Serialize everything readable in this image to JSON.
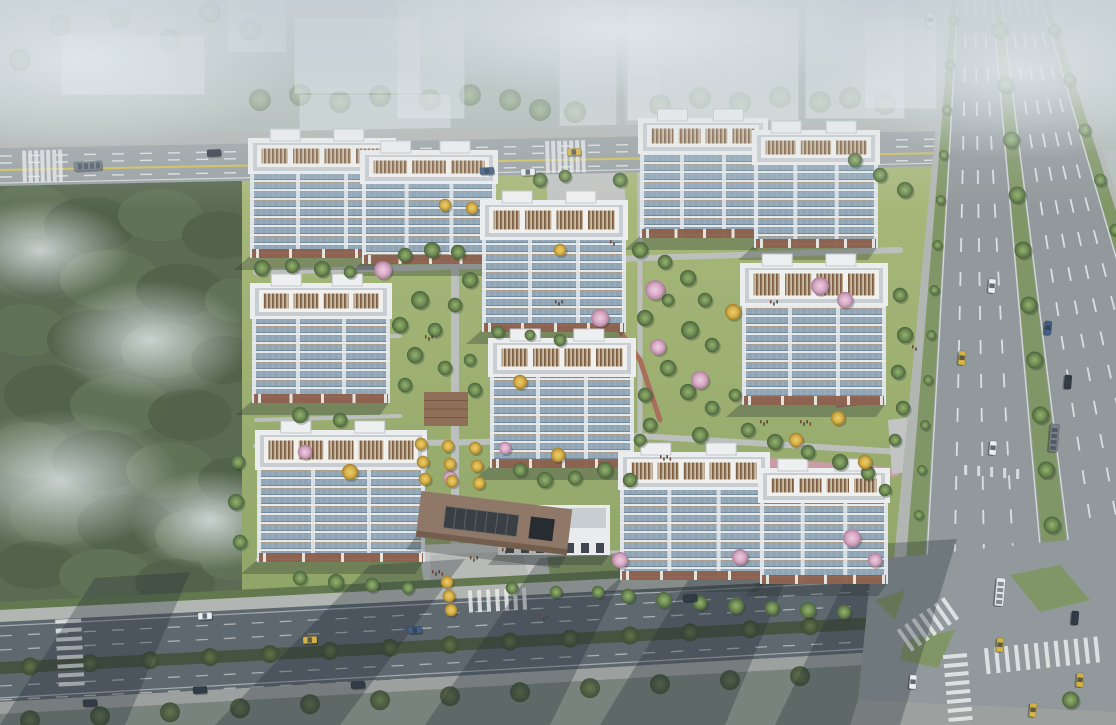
{
  "scene": {
    "type": "aerial-architectural-rendering",
    "description": "Bird's-eye architectural rendering of a residential compound: nine white high-rise apartment slabs with brown roof louvers around landscaped gardens, bordered by a forest on the west, city roads on the north and south, and a wide tree-lined highway on the east, fading into haze at the top.",
    "time_of_day": "daytime-hazy"
  },
  "palette": {
    "haze": "#c7d1d7",
    "context": "#e9eef2",
    "forest0": "#4d5e45",
    "forest1": "#5d7052",
    "fog": "#dfe8ec",
    "lawnA": "#a3b573",
    "lawnB": "#8da464",
    "path": "#bcc0bd",
    "brick": "#a96a58",
    "pinkpath": "#c99ba6",
    "deck": "#8d6b52",
    "road": "#9aa1a3",
    "roadDark": "#59646b",
    "intersection": "#8f979a",
    "sidewalk": "#b2b6b3",
    "sidewalkDark": "#9aa09d",
    "hedge": "#5e7449",
    "hedgeDark": "#3f4e3a",
    "yellow": "#d2c254",
    "white": "#eceeee",
    "highway": "#8f979a",
    "verge": "#7e9462",
    "bldgWhite": "#eef0f1",
    "roofGray": "#c9ced2",
    "louverFrame": "#f3f3f1",
    "baseBrown": "#8a5a45",
    "facadeEdge": "#e8ecef",
    "canopy": "#8d7464",
    "canopyEdge": "#6f5948",
    "skylight": "#33383e",
    "carWhite": "#eef1f2",
    "carDark": "#2b333d",
    "carBlue": "#3c5a82",
    "taxi": "#d6b23e",
    "busDark": "#757e85",
    "busWhite": "#e8eaeb",
    "shadow": "rgba(35,45,45,0.32)",
    "roadShadow": "rgba(26,35,46,0.30)"
  },
  "buildings": [
    [
      638,
      118,
      130,
      120,
      4
    ],
    [
      752,
      130,
      128,
      118,
      3
    ],
    [
      248,
      138,
      148,
      120,
      4
    ],
    [
      360,
      150,
      138,
      114,
      3
    ],
    [
      480,
      200,
      148,
      132,
      4
    ],
    [
      740,
      263,
      148,
      142,
      4
    ],
    [
      250,
      283,
      142,
      120,
      4
    ],
    [
      488,
      338,
      148,
      130,
      4
    ],
    [
      255,
      430,
      172,
      132,
      5
    ],
    [
      618,
      452,
      152,
      128,
      5
    ],
    [
      758,
      468,
      132,
      116,
      4
    ]
  ],
  "clubhouse": [
    498,
    505,
    112,
    50
  ],
  "entrance_canopy": {
    "x": 418,
    "y": 500,
    "w": 152,
    "h": 46,
    "rot": 7
  },
  "top_road": {
    "x0": 0,
    "x1": 945,
    "topY0": 148,
    "topY1": 131,
    "botY0": 186,
    "botY1": 166,
    "dashes": [
      8,
      15,
      29
    ],
    "yellowOffset": 22,
    "crosswalks": [
      22,
      345,
      545
    ]
  },
  "bottom_road": {
    "x0": 0,
    "x1": 872,
    "topY0": 622,
    "topY1": 577,
    "botY0": 702,
    "botY1": 652,
    "dashes": [
      14,
      28,
      64,
      78
    ],
    "median": [
      40,
      52
    ],
    "medianTreeXs": [
      30,
      90,
      150,
      210,
      270,
      330,
      390,
      450,
      510,
      570,
      630,
      690,
      750,
      810
    ]
  },
  "highway": {
    "Ltop": 948,
    "Lbot": 878,
    "Rtop": 1052,
    "Rbot": 1296,
    "bands": [
      [
        0.0,
        0.035,
        "sidewalk"
      ],
      [
        0.035,
        0.09,
        "verge"
      ],
      [
        0.09,
        0.43,
        "asphalt"
      ],
      [
        0.43,
        0.505,
        "median"
      ],
      [
        0.505,
        0.9,
        "asphalt"
      ],
      [
        0.9,
        0.965,
        "verge"
      ],
      [
        0.965,
        1.0,
        "sidewalk"
      ]
    ],
    "dashes": [
      0.175,
      0.26,
      0.345,
      0.585,
      0.665,
      0.745,
      0.825
    ],
    "edges": [
      0.095,
      0.425,
      0.51,
      0.895
    ],
    "medianTreeYs": [
      30,
      85,
      140,
      195,
      250,
      305,
      360,
      415,
      470,
      525,
      700
    ],
    "leftVergeYs": [
      20,
      65,
      110,
      155,
      200,
      245,
      290,
      335,
      380,
      425,
      470,
      515
    ],
    "rightVergeYs": [
      30,
      80,
      130,
      180,
      230,
      280,
      330,
      380,
      430,
      705
    ],
    "medianT": 0.467,
    "leftT": 0.0625,
    "rightT": 0.9325
  },
  "forest": {
    "x": 0,
    "y": 170,
    "w": 256,
    "h": 438,
    "blobs": [
      [
        30,
        210,
        40,
        26,
        1
      ],
      [
        90,
        225,
        46,
        28,
        0
      ],
      [
        160,
        215,
        42,
        26,
        1
      ],
      [
        220,
        235,
        38,
        24,
        0
      ],
      [
        40,
        270,
        44,
        28,
        0
      ],
      [
        110,
        280,
        50,
        30,
        1
      ],
      [
        180,
        290,
        44,
        26,
        0
      ],
      [
        235,
        300,
        30,
        22,
        1
      ],
      [
        25,
        330,
        40,
        26,
        1
      ],
      [
        95,
        340,
        48,
        30,
        0
      ],
      [
        165,
        350,
        44,
        28,
        1
      ],
      [
        225,
        360,
        34,
        24,
        0
      ],
      [
        50,
        395,
        46,
        30,
        0
      ],
      [
        120,
        405,
        50,
        30,
        1
      ],
      [
        190,
        415,
        42,
        26,
        0
      ],
      [
        30,
        450,
        42,
        28,
        1
      ],
      [
        100,
        460,
        48,
        30,
        0
      ],
      [
        170,
        470,
        44,
        28,
        1
      ],
      [
        230,
        480,
        32,
        22,
        0
      ],
      [
        55,
        515,
        46,
        30,
        1
      ],
      [
        125,
        525,
        48,
        30,
        0
      ],
      [
        195,
        535,
        40,
        26,
        1
      ],
      [
        35,
        565,
        40,
        24,
        0
      ],
      [
        105,
        575,
        46,
        26,
        1
      ],
      [
        175,
        583,
        40,
        24,
        0
      ],
      [
        230,
        560,
        30,
        20,
        1
      ]
    ],
    "fog": [
      [
        60,
        480,
        120,
        70
      ],
      [
        150,
        340,
        100,
        60
      ],
      [
        40,
        250,
        90,
        50
      ],
      [
        210,
        520,
        80,
        50
      ]
    ]
  },
  "context_blocks": [
    [
      295,
      18,
      125,
      75,
      0.55
    ],
    [
      398,
      0,
      66,
      118,
      0.5
    ],
    [
      300,
      95,
      150,
      40,
      0.45
    ],
    [
      628,
      8,
      170,
      112,
      0.6
    ],
    [
      806,
      0,
      98,
      118,
      0.55
    ],
    [
      62,
      36,
      142,
      58,
      0.5
    ],
    [
      228,
      0,
      58,
      52,
      0.45
    ],
    [
      866,
      18,
      70,
      90,
      0.5
    ],
    [
      560,
      0,
      56,
      138,
      0.45
    ],
    [
      960,
      0,
      90,
      60,
      0.35
    ]
  ],
  "context_trees": [
    [
      260,
      100
    ],
    [
      300,
      95
    ],
    [
      340,
      102
    ],
    [
      380,
      96
    ],
    [
      430,
      100
    ],
    [
      470,
      95
    ],
    [
      510,
      100
    ],
    [
      660,
      105
    ],
    [
      700,
      98
    ],
    [
      740,
      103
    ],
    [
      780,
      97
    ],
    [
      820,
      102
    ],
    [
      850,
      98
    ],
    [
      885,
      104
    ],
    [
      120,
      18
    ],
    [
      170,
      40
    ],
    [
      60,
      25
    ],
    [
      20,
      60
    ],
    [
      210,
      12
    ],
    [
      250,
      30
    ],
    [
      540,
      110
    ],
    [
      575,
      112
    ]
  ],
  "site_paths": [
    {
      "pts": [
        [
          455,
          556
        ],
        [
          455,
          206
        ]
      ],
      "w": 8,
      "c": "path"
    },
    {
      "pts": [
        [
          256,
          272
        ],
        [
          478,
          266
        ],
        [
          642,
          258
        ],
        [
          900,
          250
        ]
      ],
      "w": 6,
      "c": "path"
    },
    {
      "pts": [
        [
          256,
          446
        ],
        [
          478,
          442
        ],
        [
          640,
          436
        ],
        [
          900,
          452
        ]
      ],
      "w": 6,
      "c": "path"
    },
    {
      "pts": [
        [
          640,
          160
        ],
        [
          640,
          436
        ]
      ],
      "w": 5,
      "c": "path"
    },
    {
      "pts": [
        [
          256,
          340
        ],
        [
          400,
          336
        ]
      ],
      "w": 4,
      "c": "path"
    },
    {
      "pts": [
        [
          256,
          420
        ],
        [
          400,
          416
        ]
      ],
      "w": 4,
      "c": "path"
    },
    {
      "pts": [
        [
          598,
          300
        ],
        [
          640,
          360
        ],
        [
          660,
          420
        ]
      ],
      "w": 5,
      "c": "brick"
    },
    {
      "pts": [
        [
          735,
          460
        ],
        [
          895,
          472
        ]
      ],
      "w": 9,
      "c": "pinkpath"
    },
    {
      "pts": [
        [
          258,
          560
        ],
        [
          878,
          548
        ]
      ],
      "w": 5,
      "c": "path"
    }
  ],
  "plazas": [
    {
      "pts": [
        [
          418,
          545
        ],
        [
          545,
          540
        ],
        [
          555,
          614
        ],
        [
          430,
          620
        ]
      ],
      "c": "#c6c9c6"
    },
    {
      "pts": [
        [
          545,
          160
        ],
        [
          622,
          156
        ],
        [
          626,
          206
        ],
        [
          548,
          210
        ]
      ],
      "c": "#c2c6c3"
    },
    {
      "pts": [
        [
          888,
          420
        ],
        [
          938,
          414
        ],
        [
          942,
          468
        ],
        [
          892,
          474
        ]
      ],
      "c": "#c2c6c3"
    },
    {
      "pts": [
        [
          832,
          382
        ],
        [
          866,
          378
        ],
        [
          870,
          404
        ],
        [
          836,
          408
        ]
      ],
      "c": "#a7766b"
    }
  ],
  "deck": [
    424,
    392,
    44,
    34
  ],
  "site_trees": [
    [
      262,
      268,
      0.9
    ],
    [
      292,
      266,
      0.8
    ],
    [
      322,
      269,
      0.9
    ],
    [
      350,
      272,
      0.7
    ],
    [
      405,
      255,
      0.8
    ],
    [
      432,
      250,
      0.9
    ],
    [
      458,
      252,
      0.8
    ],
    [
      470,
      280,
      0.9
    ],
    [
      455,
      305,
      0.8
    ],
    [
      420,
      300,
      1.0
    ],
    [
      400,
      325,
      0.9
    ],
    [
      435,
      330,
      0.8
    ],
    [
      415,
      355,
      0.9
    ],
    [
      445,
      368,
      0.8
    ],
    [
      405,
      385,
      0.8
    ],
    [
      470,
      360,
      0.7
    ],
    [
      475,
      390,
      0.8
    ],
    [
      498,
      332,
      0.7
    ],
    [
      520,
      470,
      0.8
    ],
    [
      545,
      480,
      0.9
    ],
    [
      575,
      478,
      0.8
    ],
    [
      605,
      470,
      0.9
    ],
    [
      630,
      480,
      0.8
    ],
    [
      640,
      250,
      0.9
    ],
    [
      665,
      262,
      0.8
    ],
    [
      688,
      278,
      0.9
    ],
    [
      705,
      300,
      0.8
    ],
    [
      668,
      300,
      0.7
    ],
    [
      645,
      318,
      0.9
    ],
    [
      690,
      330,
      1.0
    ],
    [
      712,
      345,
      0.8
    ],
    [
      668,
      368,
      0.9
    ],
    [
      645,
      395,
      0.8
    ],
    [
      688,
      392,
      0.9
    ],
    [
      712,
      408,
      0.8
    ],
    [
      735,
      395,
      0.7
    ],
    [
      650,
      425,
      0.8
    ],
    [
      700,
      435,
      0.9
    ],
    [
      640,
      440,
      0.7
    ],
    [
      748,
      430,
      0.8
    ],
    [
      775,
      442,
      0.9
    ],
    [
      808,
      452,
      0.8
    ],
    [
      840,
      462,
      0.9
    ],
    [
      868,
      473,
      0.8
    ],
    [
      885,
      490,
      0.7
    ],
    [
      900,
      295,
      0.8
    ],
    [
      905,
      335,
      0.9
    ],
    [
      898,
      372,
      0.8
    ],
    [
      903,
      408,
      0.8
    ],
    [
      895,
      440,
      0.7
    ],
    [
      238,
      462,
      0.8
    ],
    [
      236,
      502,
      0.9
    ],
    [
      240,
      542,
      0.8
    ],
    [
      300,
      578,
      0.8
    ],
    [
      336,
      582,
      0.9
    ],
    [
      372,
      585,
      0.8
    ],
    [
      408,
      588,
      0.7
    ],
    [
      300,
      415,
      0.9
    ],
    [
      340,
      420,
      0.8
    ],
    [
      628,
      596,
      0.8
    ],
    [
      664,
      600,
      0.9
    ],
    [
      700,
      603,
      0.8
    ],
    [
      736,
      606,
      0.9
    ],
    [
      772,
      608,
      0.8
    ],
    [
      808,
      610,
      0.9
    ],
    [
      844,
      612,
      0.8
    ],
    [
      540,
      180,
      0.8
    ],
    [
      565,
      176,
      0.7
    ],
    [
      620,
      180,
      0.8
    ],
    [
      905,
      190,
      0.9
    ],
    [
      880,
      175,
      0.8
    ],
    [
      855,
      160,
      0.8
    ],
    [
      560,
      340,
      0.7
    ],
    [
      530,
      335,
      0.6
    ],
    [
      512,
      588,
      0.7
    ],
    [
      556,
      592,
      0.7
    ],
    [
      598,
      592,
      0.7
    ]
  ],
  "blossom_trees": [
    [
      383,
      270,
      1.0
    ],
    [
      600,
      318,
      1.0
    ],
    [
      655,
      290,
      1.1
    ],
    [
      658,
      347,
      0.9
    ],
    [
      700,
      380,
      1.0
    ],
    [
      820,
      286,
      1.0
    ],
    [
      845,
      300,
      0.9
    ],
    [
      620,
      560,
      0.9
    ],
    [
      740,
      557,
      0.9
    ],
    [
      852,
      538,
      1.0
    ],
    [
      450,
      478,
      0.8
    ],
    [
      305,
      452,
      0.8
    ],
    [
      875,
      560,
      0.8
    ],
    [
      505,
      448,
      0.7
    ]
  ],
  "gold_trees": [
    [
      421,
      444,
      0.7
    ],
    [
      448,
      446,
      0.7
    ],
    [
      475,
      448,
      0.7
    ],
    [
      423,
      462,
      0.7
    ],
    [
      450,
      464,
      0.7
    ],
    [
      477,
      466,
      0.7
    ],
    [
      425,
      479,
      0.7
    ],
    [
      452,
      481,
      0.7
    ],
    [
      479,
      483,
      0.7
    ],
    [
      350,
      472,
      0.9
    ],
    [
      520,
      382,
      0.8
    ],
    [
      733,
      312,
      0.9
    ],
    [
      796,
      440,
      0.8
    ],
    [
      865,
      462,
      0.8
    ],
    [
      560,
      250,
      0.7
    ],
    [
      445,
      205,
      0.7
    ],
    [
      472,
      208,
      0.7
    ],
    [
      838,
      418,
      0.8
    ],
    [
      558,
      455,
      0.8
    ],
    [
      447,
      582,
      0.7
    ],
    [
      449,
      596,
      0.7
    ],
    [
      451,
      610,
      0.7
    ]
  ],
  "cars": [
    [
      88,
      166,
      -3,
      "busDark",
      1
    ],
    [
      214,
      153,
      -3,
      "carDark",
      0
    ],
    [
      487,
      171,
      -3,
      "carBlue",
      0
    ],
    [
      528,
      172,
      -3,
      "carWhite",
      0
    ],
    [
      574,
      152,
      -3,
      "taxi",
      0
    ],
    [
      930,
      20,
      95,
      "carWhite",
      0
    ],
    [
      992,
      286,
      95,
      "carWhite",
      0
    ],
    [
      962,
      358,
      95,
      "taxi",
      0
    ],
    [
      1048,
      328,
      95,
      "carBlue",
      0
    ],
    [
      1068,
      382,
      95,
      "carDark",
      0
    ],
    [
      993,
      448,
      95,
      "carWhite",
      0
    ],
    [
      1054,
      438,
      95,
      "busDark",
      1
    ],
    [
      1000,
      645,
      95,
      "taxi",
      0
    ],
    [
      1075,
      618,
      95,
      "carDark",
      0
    ],
    [
      1080,
      680,
      95,
      "taxi",
      0
    ],
    [
      1033,
      710,
      95,
      "taxi",
      0
    ],
    [
      913,
      682,
      95,
      "carWhite",
      0
    ],
    [
      1000,
      592,
      95,
      "busWhite",
      1
    ],
    [
      205,
      616,
      -3,
      "carWhite",
      0
    ],
    [
      310,
      640,
      -3,
      "taxi",
      0
    ],
    [
      200,
      690,
      -3,
      "carDark",
      0
    ],
    [
      90,
      703,
      -3,
      "carDark",
      0
    ],
    [
      358,
      685,
      -3,
      "carDark",
      0
    ],
    [
      415,
      630,
      -3,
      "carBlue",
      0
    ],
    [
      690,
      598,
      -3,
      "carDark",
      0
    ]
  ],
  "people_clusters": [
    [
      432,
      570,
      4
    ],
    [
      470,
      556,
      3
    ],
    [
      502,
      548,
      3
    ],
    [
      660,
      455,
      4
    ],
    [
      760,
      420,
      3
    ],
    [
      800,
      420,
      4
    ],
    [
      555,
      300,
      3
    ],
    [
      610,
      240,
      2
    ],
    [
      425,
      335,
      3
    ],
    [
      912,
      345,
      2
    ],
    [
      770,
      300,
      3
    ],
    [
      540,
      615,
      3
    ]
  ],
  "road_shadows": [
    [
      95,
      578,
      0,
      725
    ],
    [
      370,
      565,
      215,
      725
    ],
    [
      540,
      558,
      425,
      725
    ],
    [
      705,
      552,
      600,
      725
    ],
    [
      862,
      545,
      775,
      725
    ]
  ],
  "zebras": [
    {
      "x": 930,
      "y": 623,
      "rot": -35,
      "n": 7,
      "len": 26,
      "sw": 4,
      "gap": 5
    },
    {
      "x": 1045,
      "y": 655,
      "rot": -6,
      "n": 12,
      "len": 26,
      "sw": 4,
      "gap": 6
    },
    {
      "x": 958,
      "y": 690,
      "rot": 85,
      "n": 8,
      "len": 24,
      "sw": 4,
      "gap": 5
    },
    {
      "x": 70,
      "y": 655,
      "rot": 87,
      "n": 8,
      "len": 26,
      "sw": 4,
      "gap": 5
    },
    {
      "x": 500,
      "y": 600,
      "rot": -3,
      "n": 7,
      "len": 22,
      "sw": 4,
      "gap": 5
    }
  ],
  "islands": [
    {
      "pts": [
        [
          905,
          640
        ],
        [
          955,
          630
        ],
        [
          938,
          668
        ],
        [
          900,
          660
        ]
      ]
    },
    {
      "pts": [
        [
          1010,
          575
        ],
        [
          1060,
          565
        ],
        [
          1090,
          600
        ],
        [
          1040,
          612
        ]
      ]
    },
    {
      "pts": [
        [
          875,
          600
        ],
        [
          905,
          590
        ],
        [
          895,
          620
        ]
      ]
    }
  ]
}
